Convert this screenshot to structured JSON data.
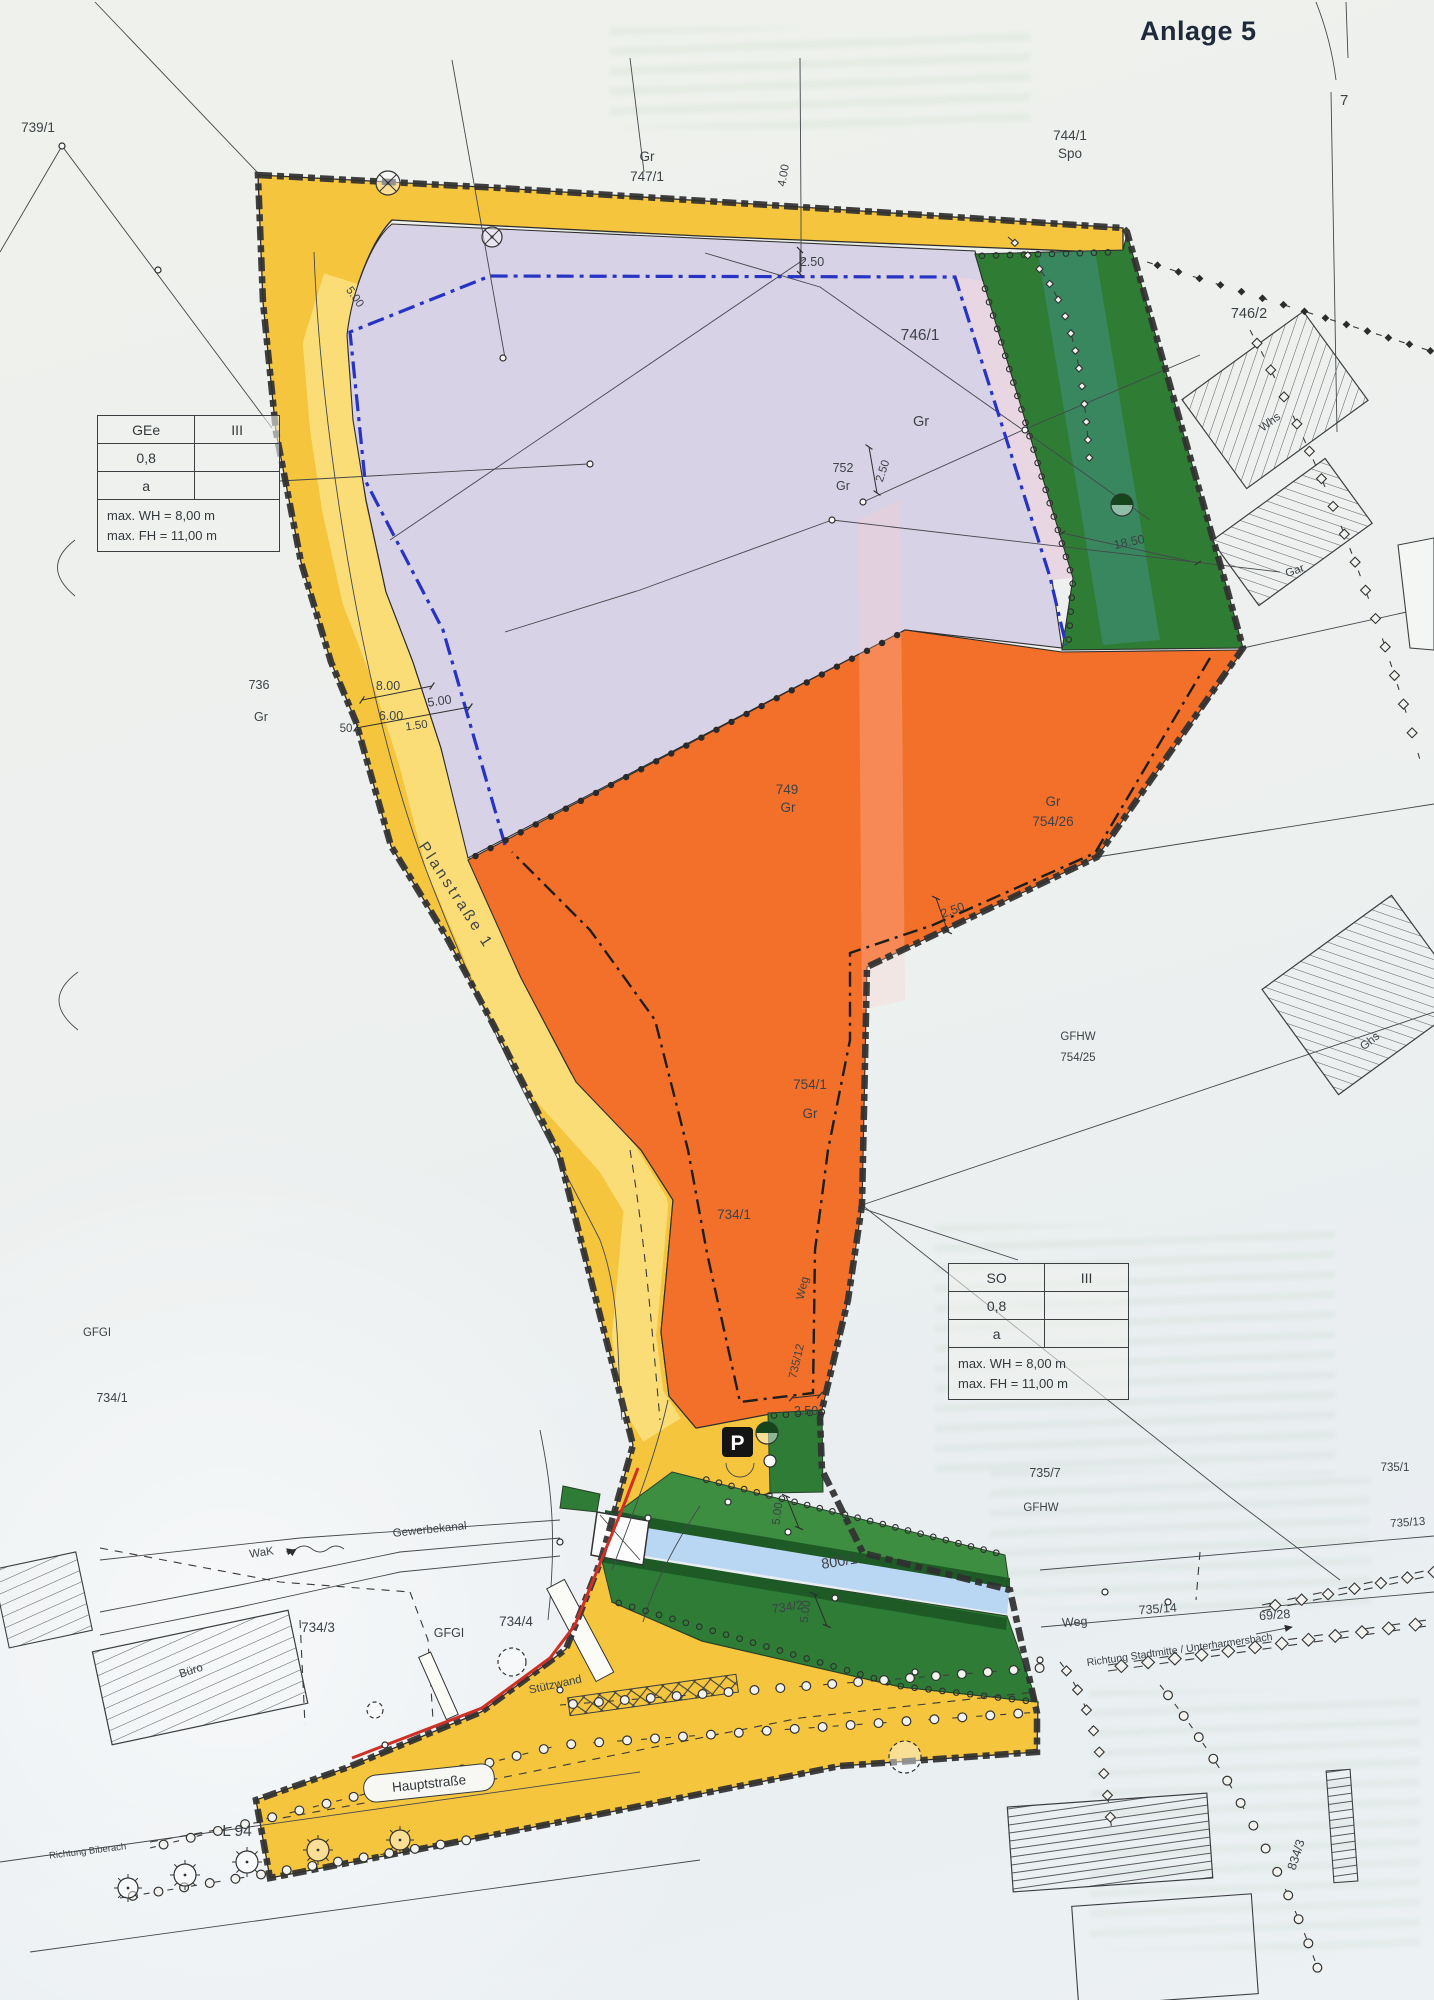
{
  "page": {
    "title": "Anlage 5",
    "sheet_number": "7"
  },
  "legend_tables": {
    "gee": {
      "zone": "GEe",
      "floors": "III",
      "ratio": "0,8",
      "bauweise": "a",
      "max_wh": "max. WH = 8,00 m",
      "max_fh": "max. FH = 11,00 m"
    },
    "so": {
      "zone": "SO",
      "floors": "III",
      "ratio": "0,8",
      "bauweise": "a",
      "max_wh": "max. WH = 8,00 m",
      "max_fh": "max. FH = 11,00 m"
    }
  },
  "streets": {
    "planstrasse": "Planstraße 1",
    "hauptstrasse": "Hauptstraße",
    "l94": "L 94",
    "weg_east": "Weg",
    "weg_path": "Weg",
    "gewerbekanal": "Gewerbekanal",
    "wak": "WaK",
    "richtung_biberach": "Richtung Biberach",
    "richtung_stadtmitte": "Richtung Stadtmitte / Unterharmersbach",
    "stuetzwand": "Stützwand"
  },
  "parcels": {
    "p739_1": "739/1",
    "p744_1": "744/1",
    "p744_1_use": "Spo",
    "p747_1": "747/1",
    "p747_1_use": "Gr",
    "p746_1": "746/1",
    "p746_1_use": "Gr",
    "p746_2": "746/2",
    "p752": "752",
    "p752_use": "Gr",
    "p736": "736",
    "p736_use": "Gr",
    "p749": "749",
    "p749_use": "Gr",
    "p754_26": "754/26",
    "p754_26_use": "Gr",
    "p754_25": "754/25",
    "p754_25_use": "GFHW",
    "p754_1": "754/1",
    "p754_1_use": "Gr",
    "p734_1_west": "734/1",
    "p734_1": "734/1",
    "p735_12": "735/12",
    "p735_7": "735/7",
    "p735_7_use": "GFHW",
    "p735_1": "735/1",
    "p735_13": "735/13",
    "p735_14": "735/14",
    "p69_28": "69/28",
    "p734_2": "734/2",
    "p734_3": "734/3",
    "p734_4": "734/4",
    "p800_1": "800/1",
    "p834_3": "834/3"
  },
  "annotations": {
    "gfgi_west": "GFGI",
    "gfgi_south": "GFGI",
    "buero": "Büro",
    "whs": "Whs",
    "gar": "Gar",
    "ghs": "Ghs",
    "parking": "P"
  },
  "dimensions": {
    "d_250_top": "2.50",
    "d_400": "4.00",
    "d_500_bend": "5.00",
    "d_800": "8.00",
    "d_600": "6.00",
    "d_150": "1.50",
    "d_50": "50",
    "d_250_752": "2.50",
    "d_1850": "18.50",
    "d_250_so": "2.50",
    "d_250_path": "2.50",
    "d_500_canal_n": "5.00",
    "d_500_canal_s": "5.00"
  },
  "colors": {
    "road_yellow": "#f6c94a",
    "road_yellow_light": "#fbdd78",
    "zone_purple": "#d8d2e6",
    "zone_orange": "#f3702a",
    "zone_green": "#2f7d35",
    "canal_blue": "#b9d6f2",
    "baugrenze_blue": "#2633c4",
    "retaining_wall_red": "#cf3026"
  }
}
